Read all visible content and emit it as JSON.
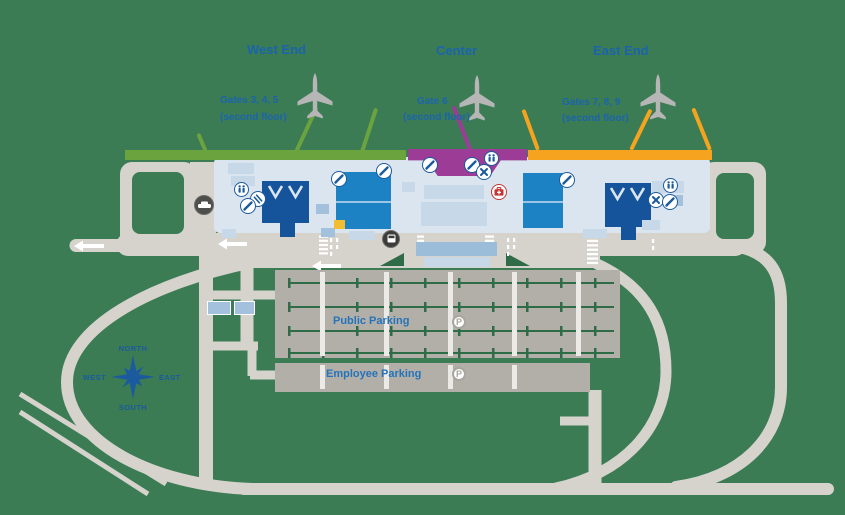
{
  "title": "Airport terminal and parking map",
  "sections": {
    "west": {
      "title": "West End",
      "gates": "Gates 3, 4, 5",
      "floor": "(second floor)"
    },
    "center": {
      "title": "Center",
      "gates": "Gate 6",
      "floor": "(second floor)"
    },
    "east": {
      "title": "East End",
      "gates": "Gates 7, 8, 9",
      "floor": "(second floor)"
    }
  },
  "parking": {
    "public_label": "Public Parking",
    "employee_label": "Employee Parking",
    "symbol": "P"
  },
  "compass": {
    "north": "NORTH",
    "south": "SOUTH",
    "east": "EAST",
    "west": "WEST"
  },
  "colors": {
    "background_green": "#3b7c54",
    "road_gray": "#d6d3cd",
    "parking_gray": "#b2afa9",
    "terminal_blue": "#dbe5ef",
    "concourse_navy": "#15539b",
    "concourse_teal": "#1d82c4",
    "curb_west_green": "#6ba33f",
    "curb_center_purple": "#9c3c96",
    "curb_east_orange": "#f6a41f",
    "accent_blue": "#1b64ad",
    "alert_red": "#c23736",
    "highlight_yellow": "#f2bd31"
  },
  "icons": [
    "airplane-icon",
    "restroom-icon",
    "dining-icon",
    "escalator-icon",
    "security-checkpoint-icon",
    "first-aid-icon",
    "car-icon",
    "bus-icon",
    "parking-icon",
    "compass-rose-icon",
    "left-arrow-icon"
  ]
}
